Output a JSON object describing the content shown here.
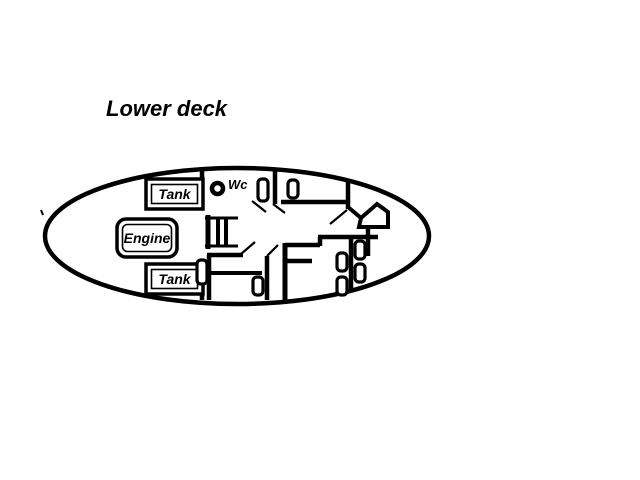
{
  "diagram": {
    "title": "Lower deck",
    "type": "boat-deck-plan",
    "colors": {
      "line": "#000000",
      "background": "#ffffff"
    },
    "labels": {
      "tank_top": "Tank",
      "engine": "Engine",
      "tank_bottom": "Tank",
      "wc": "Wc"
    }
  }
}
